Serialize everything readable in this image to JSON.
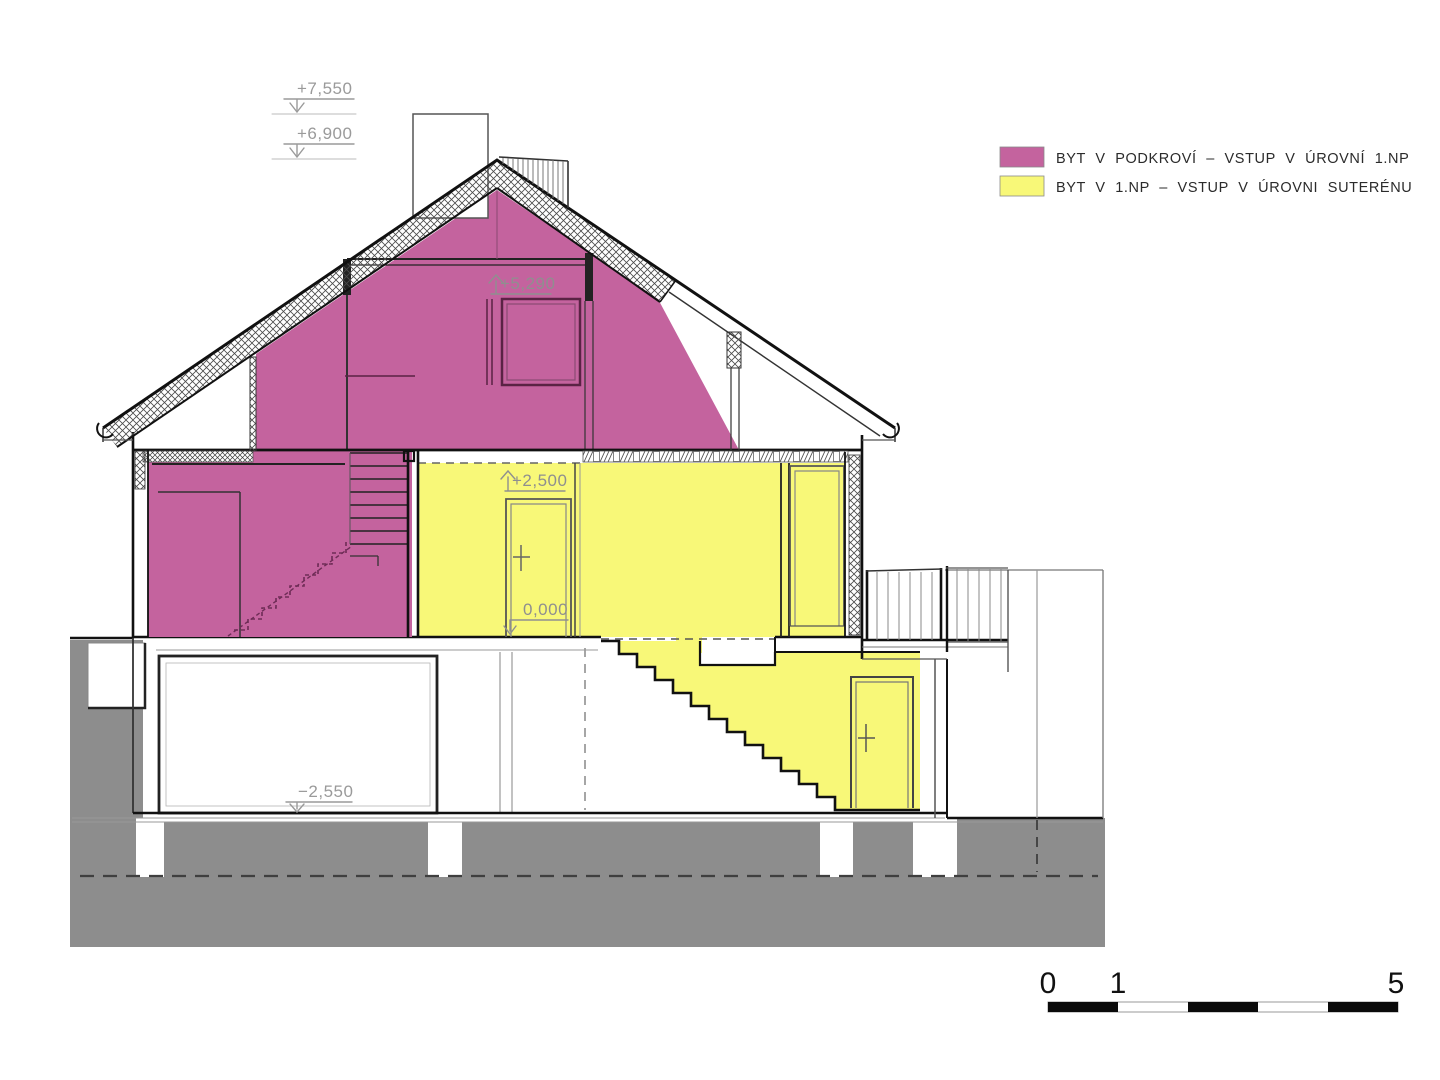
{
  "legend": {
    "items": [
      {
        "label": "BYT V PODKROVÍ – VSTUP V ÚROVNÍ 1.NP",
        "color": "#c4639e"
      },
      {
        "label": "BYT V 1.NP – VSTUP V ÚROVNI SUTERÉNU",
        "color": "#f8f878"
      }
    ]
  },
  "elevation_marks": {
    "chimney_top": "+7,550",
    "ridge": "+6,900",
    "attic_ceiling": "+5,290",
    "upper_floor": "+2,500",
    "ground_floor": "0,000",
    "basement_floor": "−2,550"
  },
  "scale_bar": {
    "labels": [
      "0",
      "1",
      "5"
    ]
  },
  "colors": {
    "terrain": "#8d8d8d",
    "outline": "#1a1a1a",
    "dim_text": "#9a9a9a",
    "paper": "#ffffff"
  }
}
